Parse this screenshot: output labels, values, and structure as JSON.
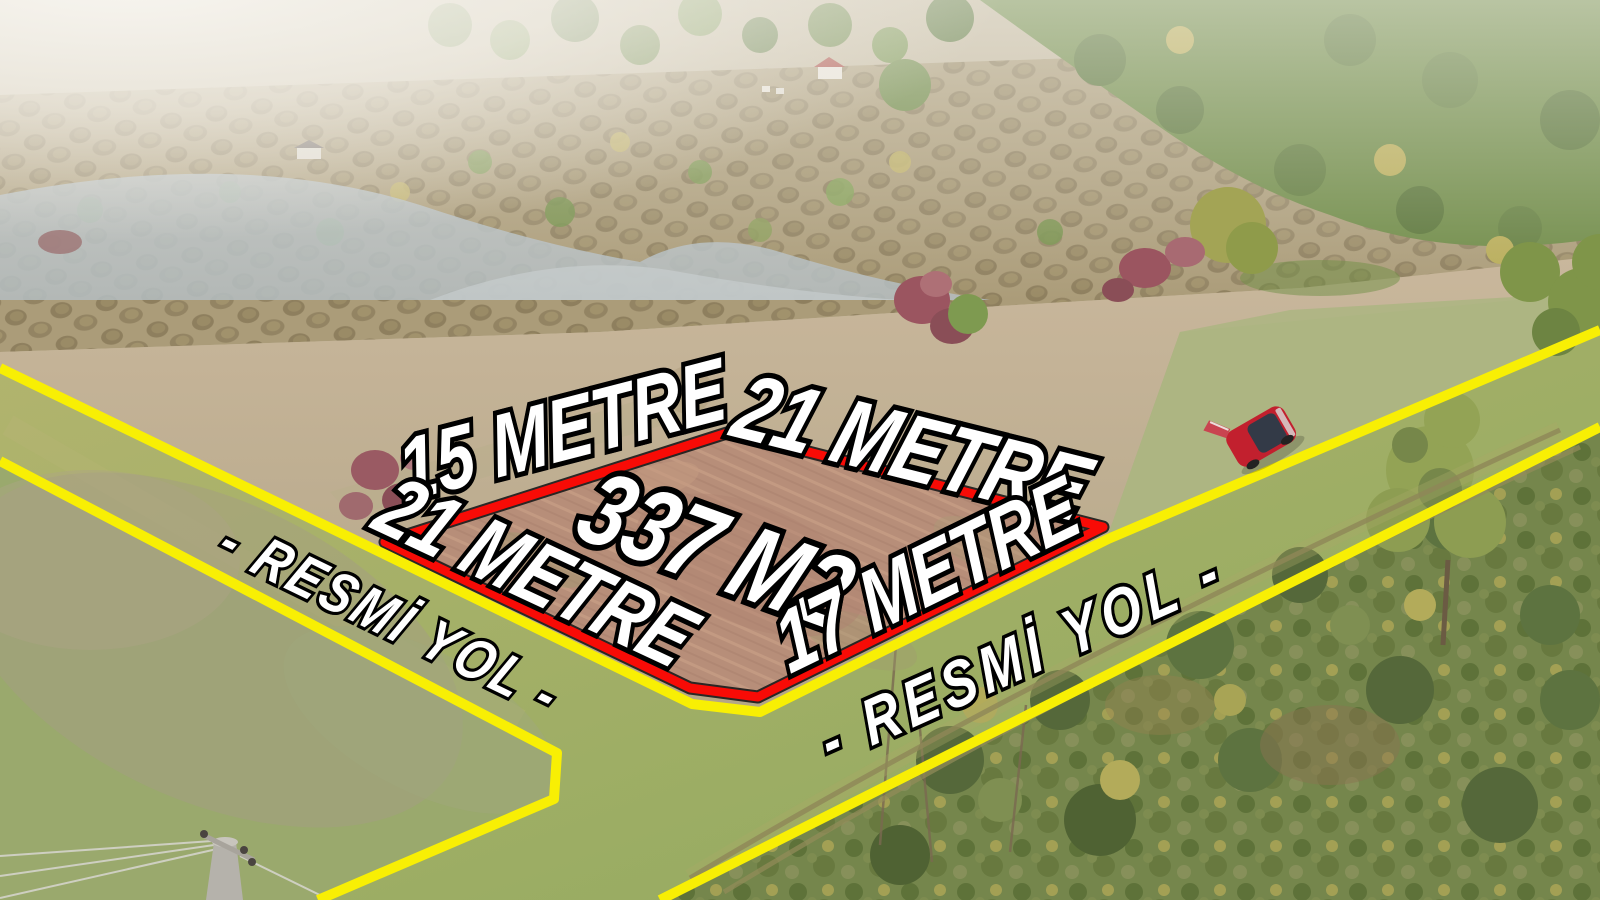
{
  "labels": {
    "side_top_left": "15 METRE",
    "side_top_right": "21 METRE",
    "side_bottom_left": "21 METRE",
    "side_bottom_right": "17 METRE",
    "area": "337 M2",
    "road_left": "- RESMİ YOL -",
    "road_right": "- RESMİ YOL -"
  },
  "colors": {
    "parcel_outline": "#f80b06",
    "road_line": "#f8ef04",
    "label_fill": "#ffffff",
    "label_outline": "#000000",
    "car_body": "#c2202e"
  }
}
